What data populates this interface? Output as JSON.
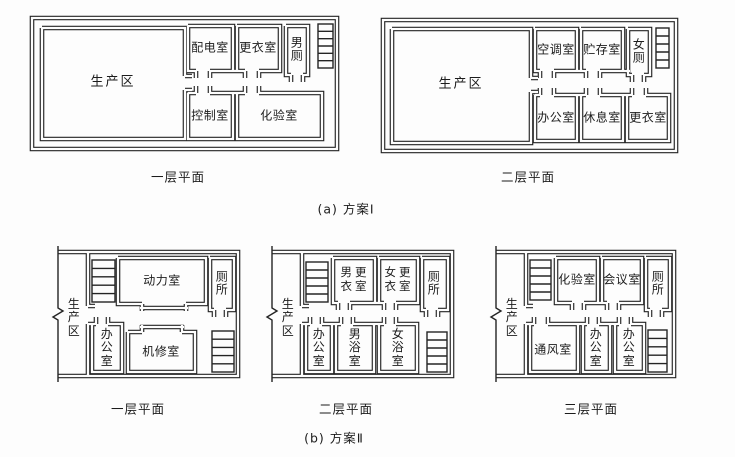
{
  "figure": {
    "scheme_a": {
      "label": "(a) 方案Ⅰ",
      "floor1": {
        "label": "一层平面",
        "production": "生产区",
        "power_distribution": "配电室",
        "changing": "更衣室",
        "mens_toilet": "男\n厕",
        "control": "控制室",
        "laboratory": "化验室"
      },
      "floor2": {
        "label": "二层平面",
        "production": "生产区",
        "air_conditioning": "空调室",
        "storage": "贮存室",
        "womens_toilet": "女\n厕",
        "office": "办公室",
        "rest": "休息室",
        "changing": "更衣室"
      }
    },
    "scheme_b": {
      "label": "(b) 方案Ⅱ",
      "floor1": {
        "label": "一层平面",
        "production": "生\n产\n区",
        "power": "动力室",
        "toilet": "厕\n所",
        "office": "办\n公\n室",
        "machine_repair": "机修室"
      },
      "floor2": {
        "label": "二层平面",
        "production": "生\n产\n区",
        "mens_changing": "男更\n衣室",
        "womens_changing": "女更\n衣室",
        "toilet": "厕\n所",
        "office": "办\n公\n室",
        "mens_bath": "男\n浴\n室",
        "womens_bath": "女\n浴\n室"
      },
      "floor3": {
        "label": "三层平面",
        "production": "生\n产\n区",
        "laboratory": "化验室",
        "meeting": "会议室",
        "toilet": "厕\n所",
        "ventilation": "通风室",
        "office1": "办\n公\n室",
        "office2": "办\n公\n室"
      }
    }
  }
}
